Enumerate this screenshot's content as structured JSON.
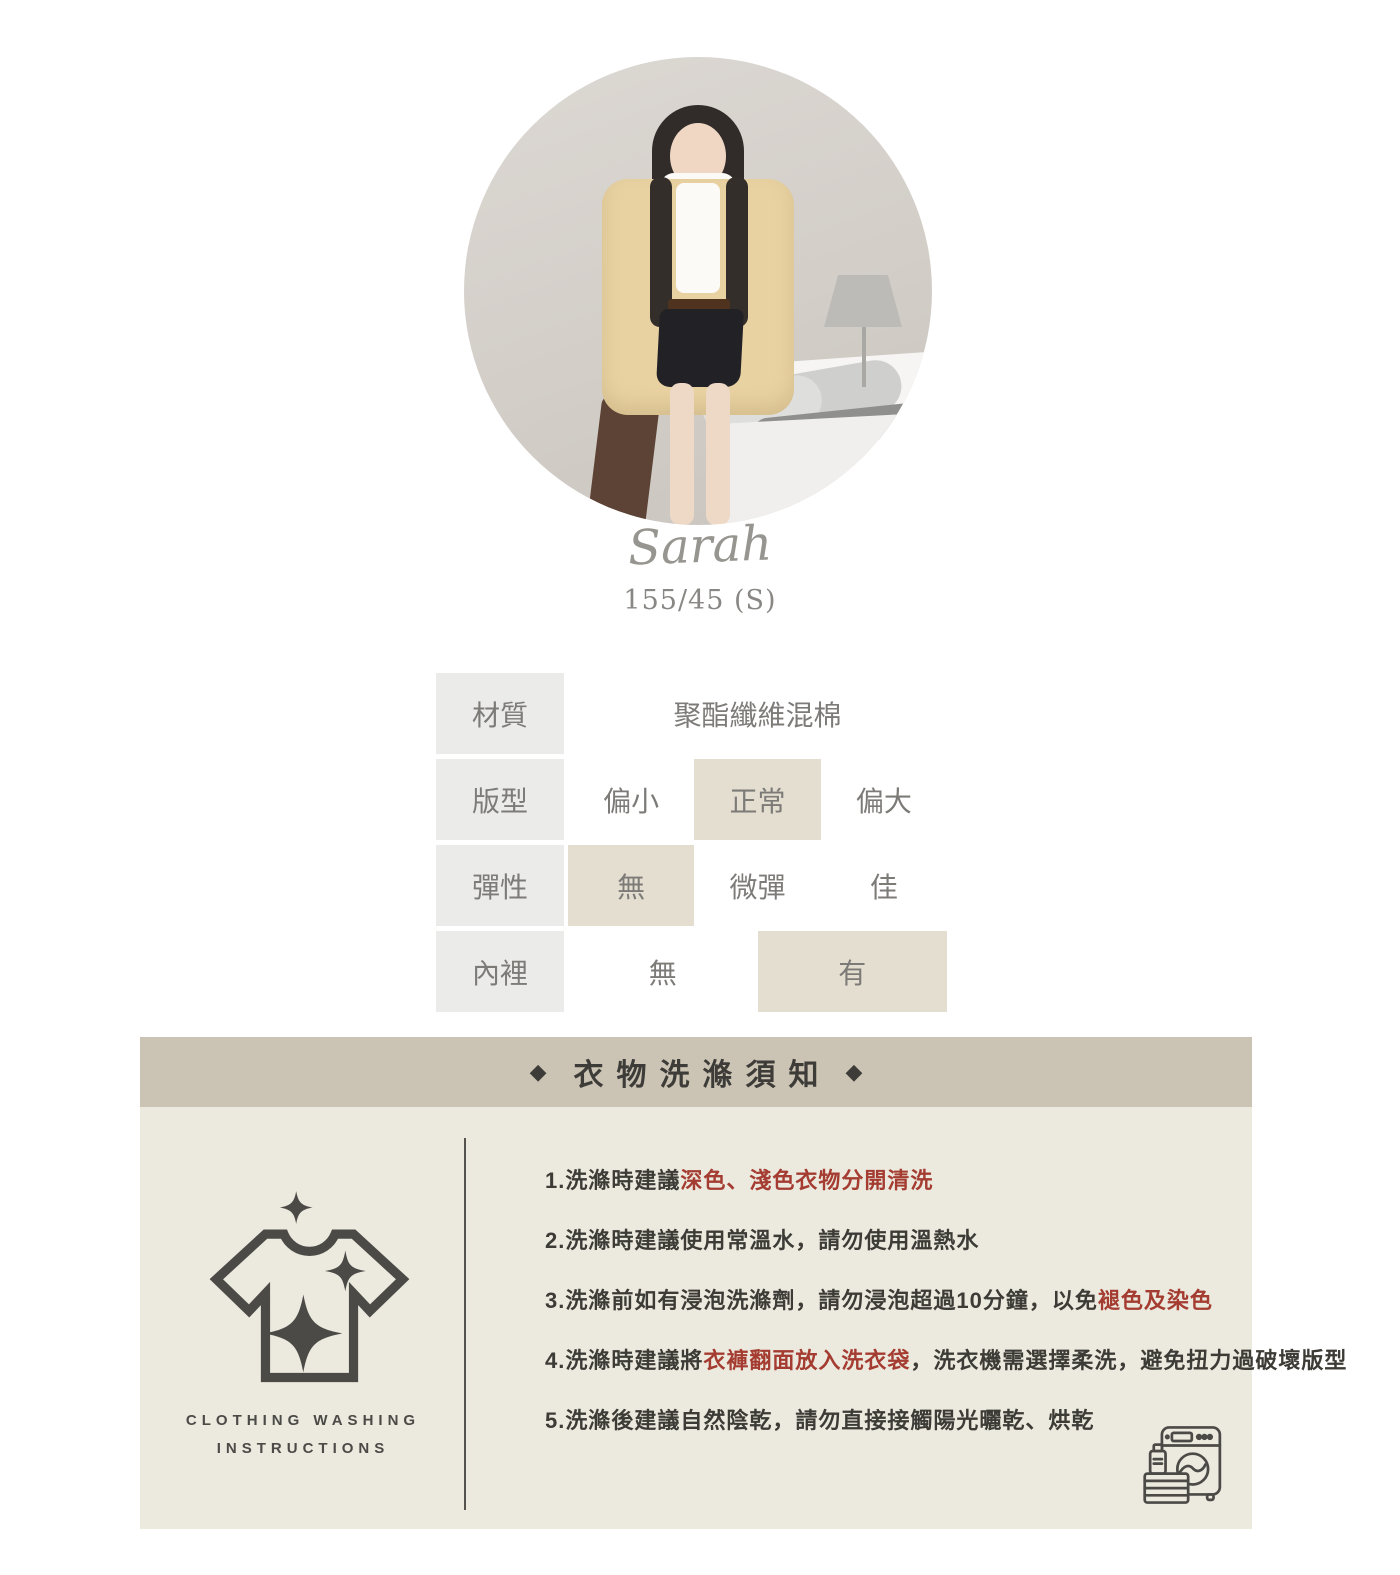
{
  "model": {
    "name": "Sarah",
    "stats": "155/45 (S)"
  },
  "spec_table": {
    "rows": [
      {
        "label": "材質",
        "value": "聚酯纖維混棉"
      },
      {
        "label": "版型",
        "options": [
          {
            "label": "偏小",
            "selected": false
          },
          {
            "label": "正常",
            "selected": true
          },
          {
            "label": "偏大",
            "selected": false
          }
        ]
      },
      {
        "label": "彈性",
        "options": [
          {
            "label": "無",
            "selected": true
          },
          {
            "label": "微彈",
            "selected": false
          },
          {
            "label": "佳",
            "selected": false
          }
        ]
      },
      {
        "label": "內裡",
        "options": [
          {
            "label": "無",
            "selected": false
          },
          {
            "label": "有",
            "selected": true
          }
        ]
      }
    ]
  },
  "washing": {
    "title": "衣物洗滌須知",
    "decor": "◆",
    "side_label_line1": "CLOTHING WASHING",
    "side_label_line2": "INSTRUCTIONS",
    "instructions": [
      {
        "segments": [
          {
            "text": "1.洗滌時建議",
            "red": false
          },
          {
            "text": "深色、淺色衣物分開清洗",
            "red": true
          }
        ]
      },
      {
        "segments": [
          {
            "text": "2.洗滌時建議使用常溫水，請勿使用溫熱水",
            "red": false
          }
        ]
      },
      {
        "segments": [
          {
            "text": "3.洗滌前如有浸泡洗滌劑，請勿浸泡超過10分鐘，以免",
            "red": false
          },
          {
            "text": "褪色及染色",
            "red": true
          }
        ]
      },
      {
        "segments": [
          {
            "text": "4.洗滌時建議將",
            "red": false
          },
          {
            "text": "衣褲翻面放入洗衣袋",
            "red": true
          },
          {
            "text": "，洗衣機需選擇柔洗，避免扭力過破壞版型",
            "red": false
          }
        ]
      },
      {
        "segments": [
          {
            "text": "5.洗滌後建議自然陰乾，請勿直接接觸陽光曬乾、烘乾",
            "red": false
          }
        ]
      }
    ]
  },
  "icons": {
    "tshirt": "tshirt-sparkle-icon",
    "washing_machine": "washing-machine-icon",
    "diamond_glyph": "◆"
  },
  "colors": {
    "header_bar": "#cbc4b4",
    "body_panel": "#ece9de",
    "table_label_bg": "#ebebea",
    "table_highlight_bg": "#e3ded0",
    "table_text": "#7d7b78",
    "instruction_text": "#3c3b36",
    "instruction_highlight": "#a43c31",
    "icon_stroke": "#4b4a46"
  }
}
